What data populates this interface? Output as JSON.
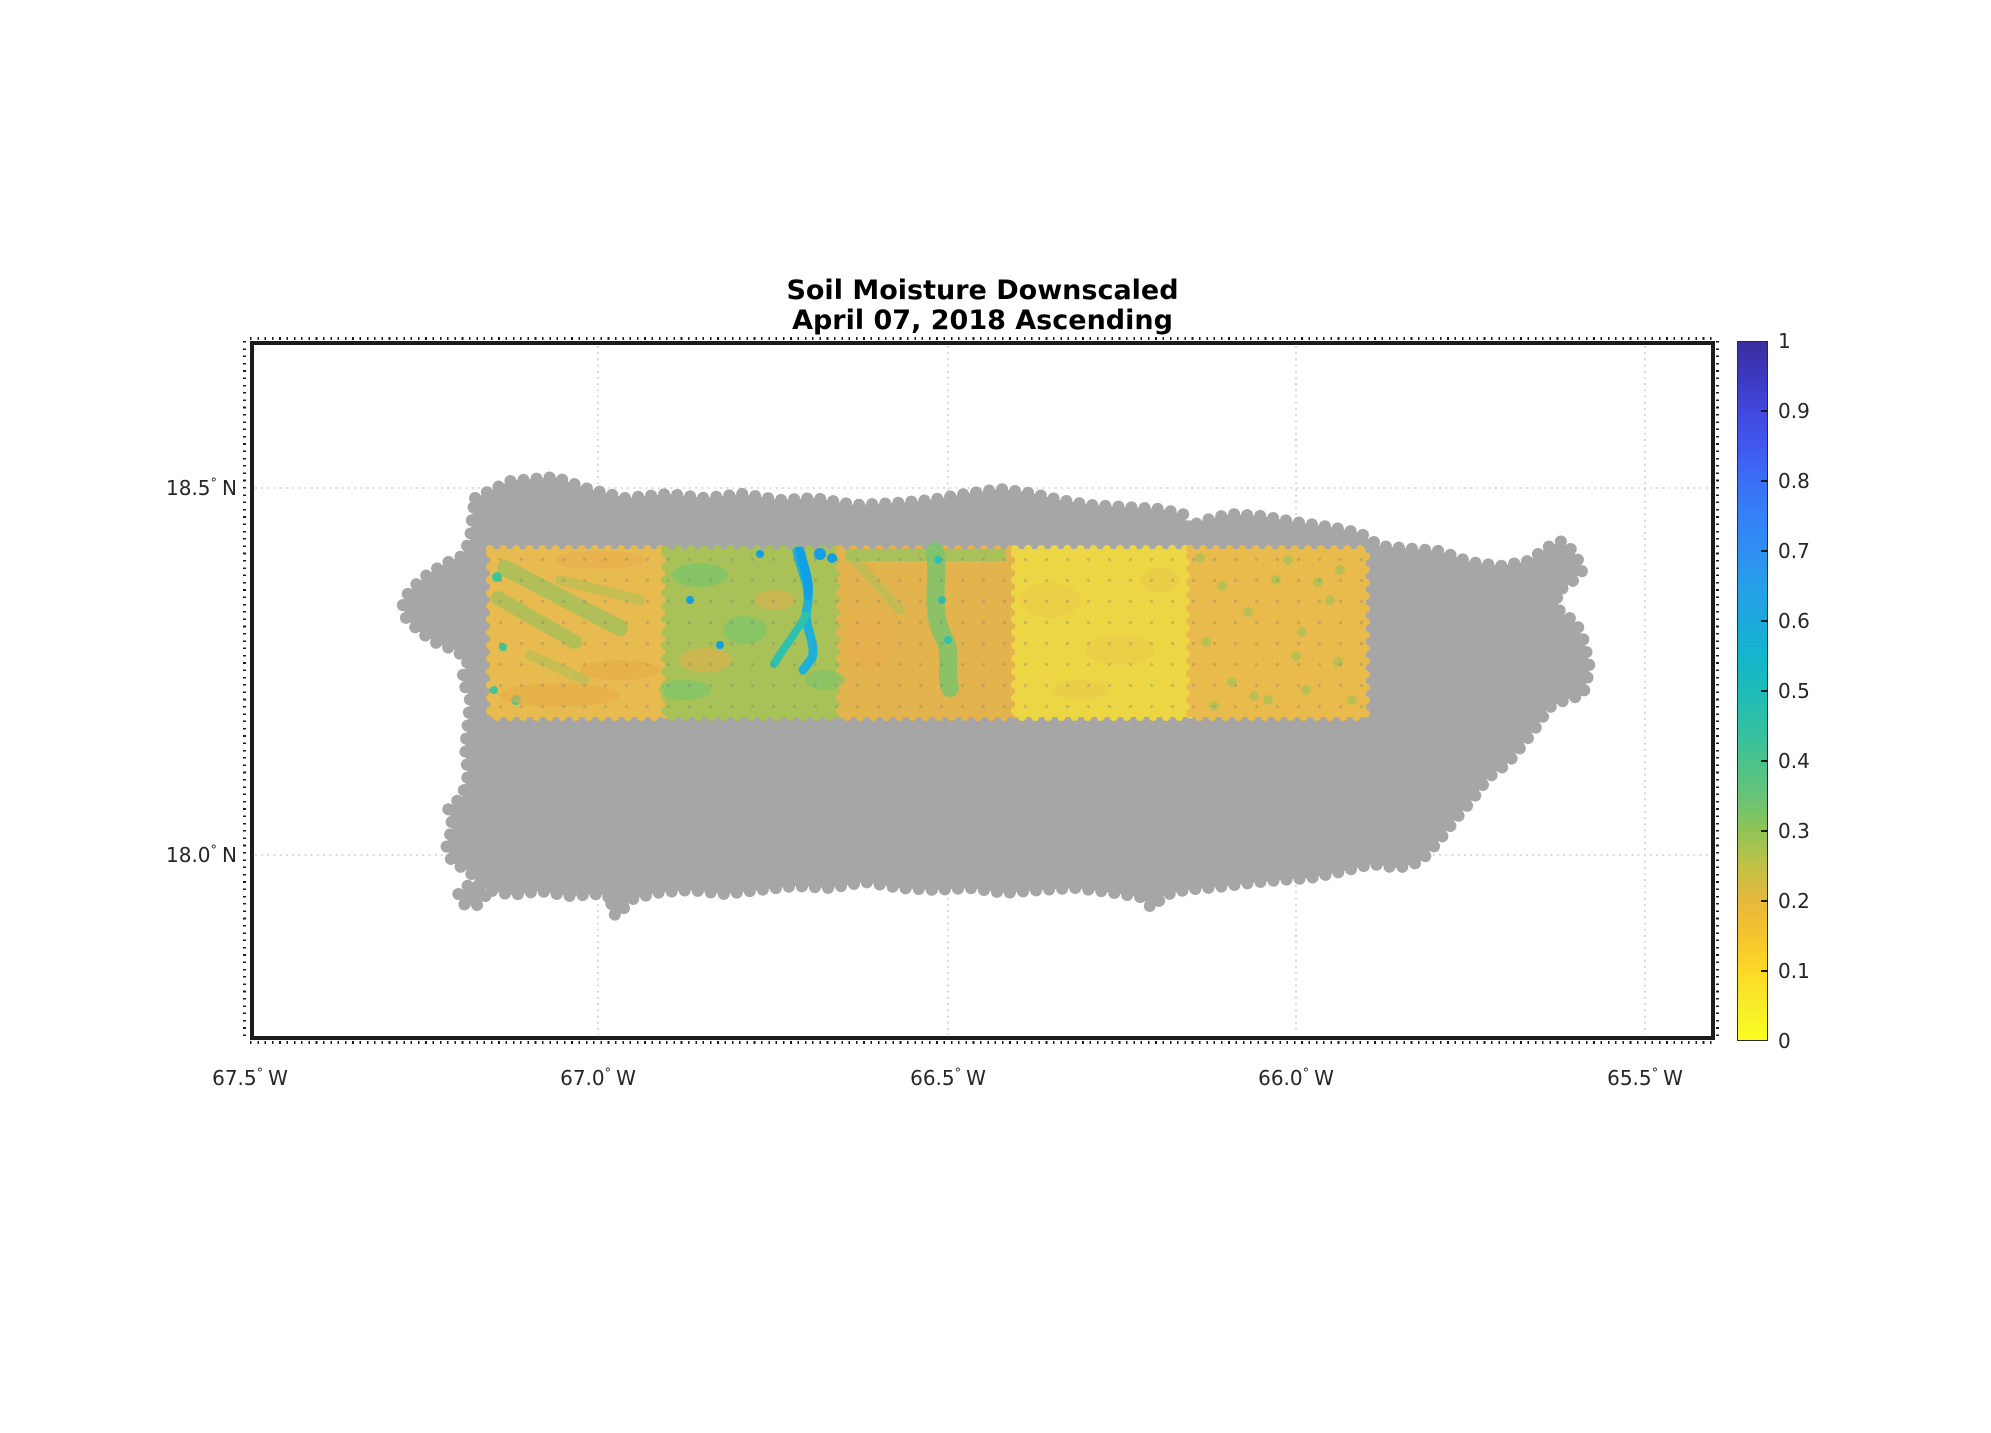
{
  "figure": {
    "title_line1": "Soil Moisture Downscaled",
    "title_line2": "April 07, 2018 Ascending"
  },
  "axes": {
    "x_ticks": [
      {
        "value": "67.5",
        "degree": "°",
        "hemi": "W"
      },
      {
        "value": "67.0",
        "degree": "°",
        "hemi": "W"
      },
      {
        "value": "66.5",
        "degree": "°",
        "hemi": "W"
      },
      {
        "value": "66.0",
        "degree": "°",
        "hemi": "W"
      },
      {
        "value": "65.5",
        "degree": "°",
        "hemi": "W"
      }
    ],
    "y_ticks": [
      {
        "value": "18.5",
        "degree": "°",
        "hemi": "N"
      },
      {
        "value": "18.0",
        "degree": "°",
        "hemi": "N"
      }
    ]
  },
  "colorbar": {
    "ticks": [
      "1",
      "0.9",
      "0.8",
      "0.7",
      "0.6",
      "0.5",
      "0.4",
      "0.3",
      "0.2",
      "0.1",
      "0"
    ],
    "gradient_stops": [
      {
        "v": 1.0,
        "color": "#3c2e9e"
      },
      {
        "v": 0.95,
        "color": "#3c38c0"
      },
      {
        "v": 0.9,
        "color": "#4148dd"
      },
      {
        "v": 0.85,
        "color": "#4058ee"
      },
      {
        "v": 0.8,
        "color": "#3a70f6"
      },
      {
        "v": 0.75,
        "color": "#3580f7"
      },
      {
        "v": 0.7,
        "color": "#2f8ff2"
      },
      {
        "v": 0.65,
        "color": "#279fe8"
      },
      {
        "v": 0.6,
        "color": "#1caadd"
      },
      {
        "v": 0.55,
        "color": "#14b4cb"
      },
      {
        "v": 0.5,
        "color": "#1dbcb8"
      },
      {
        "v": 0.45,
        "color": "#30c0a4"
      },
      {
        "v": 0.4,
        "color": "#49c28c"
      },
      {
        "v": 0.35,
        "color": "#68c377"
      },
      {
        "v": 0.3,
        "color": "#8ec455"
      },
      {
        "v": 0.25,
        "color": "#c0c246"
      },
      {
        "v": 0.2,
        "color": "#e7b83d"
      },
      {
        "v": 0.15,
        "color": "#f6c32f"
      },
      {
        "v": 0.1,
        "color": "#fbd927"
      },
      {
        "v": 0.05,
        "color": "#f8ec28"
      },
      {
        "v": 0.0,
        "color": "#fafc20"
      }
    ]
  },
  "map": {
    "background": "#ffffff",
    "island_color": "#a6a6a6",
    "gridline_color": "#cdcdcd"
  },
  "palette": {
    "streak_olive": "#a6c058",
    "streak_green": "#74c46e",
    "green_top": "#9dc45c",
    "river_cyan": "#1fb0d8",
    "river_teal": "#2fc0ae",
    "cyan_deep": "#119fe6",
    "teal_speck": "#3cc49b",
    "orange_patch": "#e2ae4b",
    "orange_soft": "#eaac4a",
    "speck_olive": "#b2c156",
    "yellow_mottle": "#e8c94a"
  },
  "chart_data": {
    "type": "heatmap",
    "title": "Soil Moisture Downscaled",
    "subtitle": "April 07, 2018 Ascending",
    "region": "Puerto Rico shown as gray landmask scatter",
    "x_axis": {
      "ticks_deg_w": [
        67.5,
        67.0,
        66.5,
        66.0,
        65.5
      ],
      "range_deg_w": [
        67.5,
        65.4
      ],
      "label_format": "{value}° W"
    },
    "y_axis": {
      "ticks_deg_n": [
        18.5,
        18.0
      ],
      "range_deg_n": [
        17.75,
        18.7
      ],
      "label_format": "{value}° N"
    },
    "gridlines": "dotted light gray at labeled ticks",
    "colorbar": {
      "title": "soil moisture (volumetric)",
      "range": [
        0,
        1
      ],
      "tick_step": 0.1,
      "colormap": "parula reversed (0 = bright yellow, 1 = dark indigo blue)",
      "position": "right"
    },
    "swath": {
      "description": "Downscaled SMAP soil-moisture swath band overlaid on island",
      "lon_w_extent": [
        67.15,
        65.9
      ],
      "lat_n_extent": [
        18.19,
        18.42
      ],
      "tile_boundaries_lon_w": [
        67.15,
        66.9,
        66.65,
        66.4,
        66.15,
        65.9
      ],
      "tiles": [
        {
          "lon_w": [
            67.15,
            66.9
          ],
          "base_color": "#e7bb4f",
          "moisture_approx": [
            0.1,
            0.4
          ],
          "description": "orange-yellow with diagonal yellow-green streaks and a few teal specks"
        },
        {
          "lon_w": [
            66.9,
            66.65
          ],
          "base_color": "#a9c257",
          "moisture_approx": [
            0.2,
            0.6
          ],
          "description": "yellow-green (wettest tile) with branching cyan stream channels"
        },
        {
          "lon_w": [
            66.65,
            66.4
          ],
          "base_color": "#e3b44e",
          "moisture_approx": [
            0.1,
            0.5
          ],
          "description": "orange-yellow, green stream streak with teal specks on right side"
        },
        {
          "lon_w": [
            66.4,
            66.15
          ],
          "base_color": "#edd644",
          "moisture_approx": [
            0.05,
            0.2
          ],
          "description": "bright yellow (driest tile), nearly uniform"
        },
        {
          "lon_w": [
            66.15,
            65.9
          ],
          "base_color": "#e9ba4c",
          "moisture_approx": [
            0.1,
            0.35
          ],
          "description": "orange-yellow with scattered yellow-green specks"
        }
      ]
    }
  }
}
